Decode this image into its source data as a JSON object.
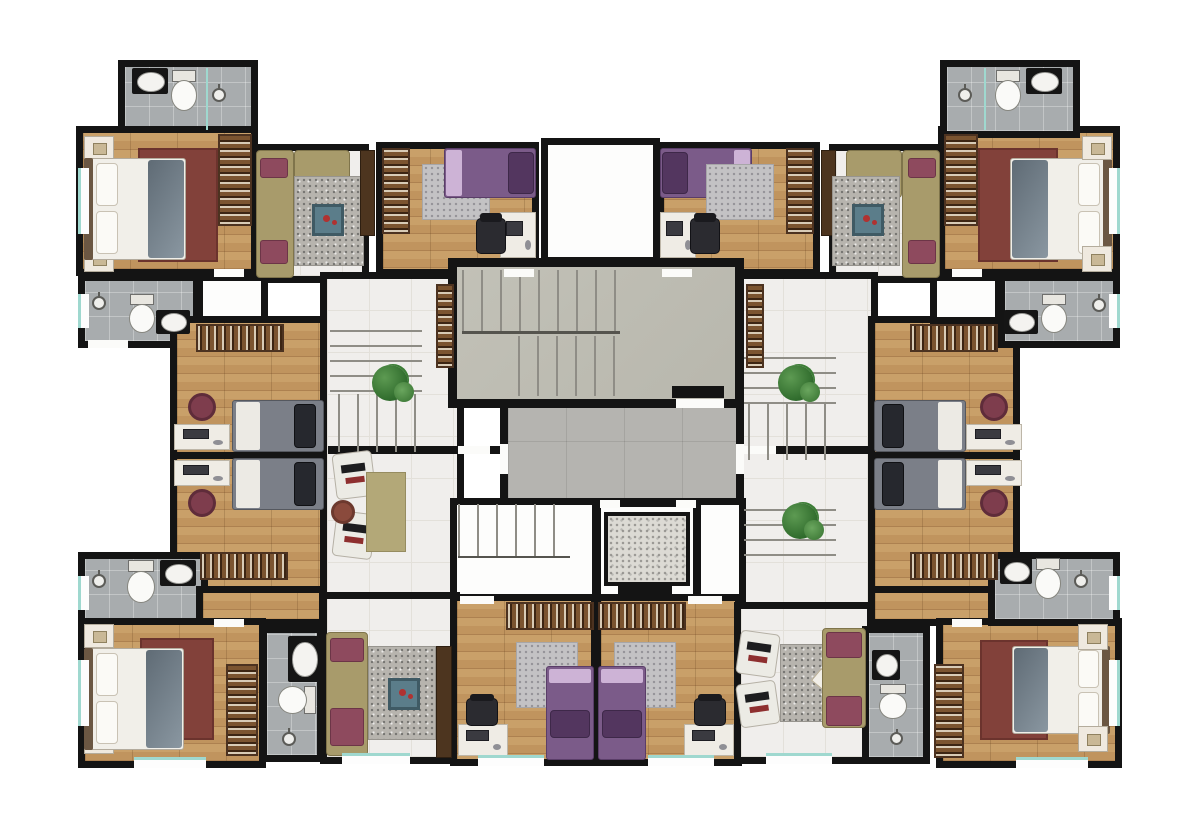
{
  "title": "residential-floor-plan-render",
  "visible_text": [],
  "palette": {
    "wall": "#141414",
    "wood_a": "#c9a069",
    "wood_b": "#c0945e",
    "wood_line": "#ad8150",
    "bath_tile": "#a8acae",
    "hall_tile": "#f0eeec",
    "hall_line": "#e3e0da",
    "corridor_tile": "#b5b4b0",
    "concrete": "#bdbcb2",
    "granite": "#dcdad4",
    "white_floor": "#fdfdfc",
    "stair_line": "#8f8d86",
    "rug_red": "#82413a",
    "rug_gray": "#b7b4ae",
    "rug_olive": "#b3a878",
    "bed_linen": "#f1efe9",
    "pillow_white": "#fbfaf6",
    "blanket": "#5f6b75",
    "bed_purple": "#7b5b89",
    "pillow_purple": "#53365f",
    "sheet_purple": "#cdb3d6",
    "bed_gray": "#7b7f88",
    "pillow_dark": "#26282e",
    "sofa_olive": "#a89b6b",
    "cushion_maroon": "#8e4a5e",
    "wardrobe": "#6f4c2f",
    "desk": "#efece5",
    "chair_black": "#2b2b30",
    "chair_maroon": "#7e3d4d",
    "plant": "#2f6b2c",
    "plant_light": "#5d9a52",
    "table_blue": "#5b7d8a",
    "accent_red": "#b03231",
    "window_teal": "#9fd8cf",
    "tv_brown": "#4d351f"
  },
  "plan": {
    "type": "apartment-building storey, top-down furnished render, mirrored left/right",
    "core": [
      "main-switchback-staircase",
      "central-corridor",
      "secondary-staircase",
      "elevator",
      "service-shaft",
      "light-well"
    ],
    "halls": [
      "left-hall with winder stairs, plant, two armchairs, pouf, olive rug",
      "right-hall with winder stairs and two plants"
    ],
    "units": [
      {
        "id": "top-left",
        "rooms": [
          "bathroom",
          "master-bedroom",
          "living-room"
        ]
      },
      {
        "id": "top-center-left",
        "rooms": [
          "purple-single-bedroom with desk"
        ]
      },
      {
        "id": "top-center-right",
        "rooms": [
          "purple-single-bedroom with desk"
        ]
      },
      {
        "id": "top-right",
        "rooms": [
          "bathroom",
          "master-bedroom",
          "living-room"
        ]
      },
      {
        "id": "middle-left",
        "rooms": [
          "bathroom",
          "utility",
          "gray-bed-room-upper",
          "gray-bed-room-lower"
        ]
      },
      {
        "id": "middle-right",
        "rooms": [
          "bathroom",
          "utility",
          "gray-bed-room-upper",
          "gray-bed-room-lower"
        ]
      },
      {
        "id": "bottom-left",
        "rooms": [
          "bathroom",
          "master-bedroom",
          "ensuite-bathroom",
          "living-room"
        ]
      },
      {
        "id": "bottom-center",
        "rooms": [
          "purple-single-bedroom-left",
          "purple-single-bedroom-right"
        ]
      },
      {
        "id": "bottom-right",
        "rooms": [
          "living-room",
          "bathroom",
          "master-bedroom",
          "upper-bathroom"
        ]
      }
    ]
  }
}
